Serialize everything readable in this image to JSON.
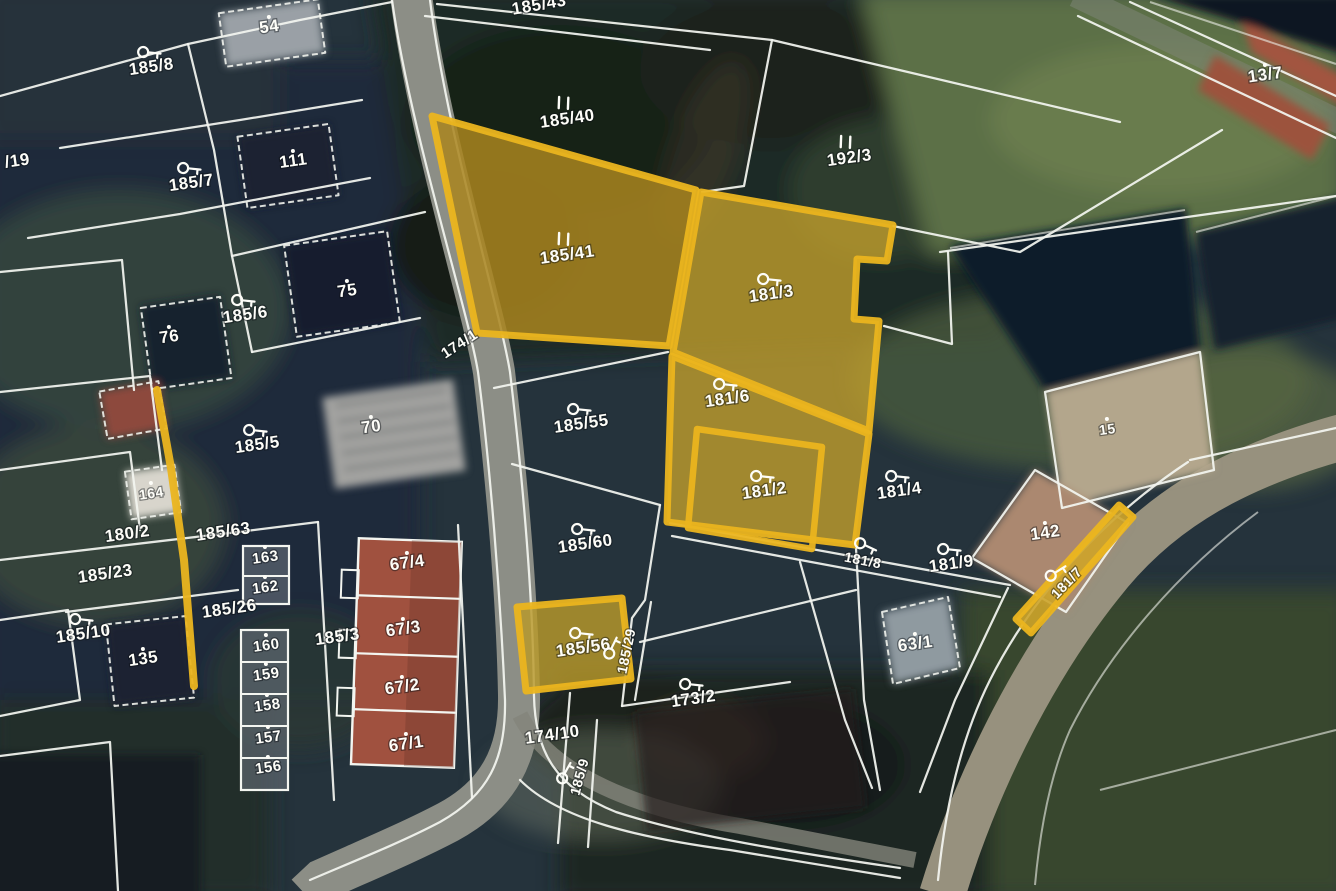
{
  "map": {
    "type": "cadastral-satellite-overlay",
    "colors": {
      "boundary_line": "#f3f5f0",
      "highlight_stroke": "#ebb51f",
      "highlight_fill_dark": "#a9851f",
      "highlight_fill_light": "#c4a02b",
      "label_text": "#fdfdf8"
    },
    "labels": [
      {
        "text": "54",
        "x": 270,
        "y": 32,
        "rot": -8,
        "dot": true
      },
      {
        "text": "185/8",
        "x": 152,
        "y": 72,
        "rot": -8,
        "icon": "key"
      },
      {
        "text": "/19",
        "x": 18,
        "y": 166,
        "rot": -8
      },
      {
        "text": "185/7",
        "x": 192,
        "y": 188,
        "rot": -8,
        "icon": "key"
      },
      {
        "text": "111",
        "x": 294,
        "y": 166,
        "rot": -8,
        "dot": true
      },
      {
        "text": "76",
        "x": 170,
        "y": 342,
        "rot": -8,
        "dot": true
      },
      {
        "text": "185/6",
        "x": 246,
        "y": 320,
        "rot": -8,
        "icon": "key"
      },
      {
        "text": "75",
        "x": 348,
        "y": 296,
        "rot": -8,
        "dot": true
      },
      {
        "text": "185/5",
        "x": 258,
        "y": 450,
        "rot": -8,
        "icon": "key"
      },
      {
        "text": "70",
        "x": 372,
        "y": 432,
        "rot": -8,
        "dot": true
      },
      {
        "text": "164",
        "x": 152,
        "y": 498,
        "rot": -8,
        "dot": true,
        "size": 14
      },
      {
        "text": "180/2",
        "x": 128,
        "y": 539,
        "rot": -8
      },
      {
        "text": "185/63",
        "x": 224,
        "y": 537,
        "rot": -8
      },
      {
        "text": "185/23",
        "x": 106,
        "y": 579,
        "rot": -8
      },
      {
        "text": "163",
        "x": 266,
        "y": 562,
        "rot": -8,
        "dot": true,
        "size": 15
      },
      {
        "text": "162",
        "x": 266,
        "y": 592,
        "rot": -8,
        "dot": true,
        "size": 15
      },
      {
        "text": "185/26",
        "x": 230,
        "y": 614,
        "rot": -8
      },
      {
        "text": "160",
        "x": 267,
        "y": 650,
        "rot": -8,
        "dot": true,
        "size": 15
      },
      {
        "text": "159",
        "x": 267,
        "y": 679,
        "rot": -8,
        "dot": true,
        "size": 15
      },
      {
        "text": "158",
        "x": 268,
        "y": 710,
        "rot": -8,
        "dot": true,
        "size": 15
      },
      {
        "text": "157",
        "x": 269,
        "y": 742,
        "rot": -8,
        "dot": true,
        "size": 15
      },
      {
        "text": "156",
        "x": 269,
        "y": 772,
        "rot": -8,
        "dot": true,
        "size": 15
      },
      {
        "text": "185/10",
        "x": 84,
        "y": 639,
        "rot": -8,
        "icon": "key"
      },
      {
        "text": "135",
        "x": 144,
        "y": 664,
        "rot": -8,
        "dot": true
      },
      {
        "text": "185/3",
        "x": 338,
        "y": 642,
        "rot": -8
      },
      {
        "text": "67/4",
        "x": 408,
        "y": 568,
        "rot": -8,
        "dot": true
      },
      {
        "text": "67/3",
        "x": 404,
        "y": 634,
        "rot": -8,
        "dot": true
      },
      {
        "text": "67/2",
        "x": 403,
        "y": 692,
        "rot": -8,
        "dot": true
      },
      {
        "text": "67/1",
        "x": 407,
        "y": 749,
        "rot": -8,
        "dot": true
      },
      {
        "text": "185/43",
        "x": 540,
        "y": 10,
        "rot": -10
      },
      {
        "text": "185/40",
        "x": 568,
        "y": 124,
        "rot": -8,
        "mark": true
      },
      {
        "text": "192/3",
        "x": 850,
        "y": 163,
        "rot": -8,
        "mark": true
      },
      {
        "text": "13/7",
        "x": 1266,
        "y": 80,
        "rot": -8,
        "dot": true
      },
      {
        "text": "185/41",
        "x": 568,
        "y": 260,
        "rot": -8,
        "mark": true
      },
      {
        "text": "174/1",
        "x": 462,
        "y": 348,
        "rot": -33,
        "size": 15
      },
      {
        "text": "185/55",
        "x": 582,
        "y": 429,
        "rot": -8,
        "icon": "key"
      },
      {
        "text": "181/3",
        "x": 772,
        "y": 299,
        "rot": -8,
        "icon": "key"
      },
      {
        "text": "181/6",
        "x": 728,
        "y": 404,
        "rot": -8,
        "icon": "key"
      },
      {
        "text": "181/2",
        "x": 765,
        "y": 496,
        "rot": -8,
        "icon": "key"
      },
      {
        "text": "181/4",
        "x": 900,
        "y": 496,
        "rot": -8,
        "icon": "key"
      },
      {
        "text": "15",
        "x": 1108,
        "y": 434,
        "rot": -8,
        "dot": true,
        "size": 14
      },
      {
        "text": "142",
        "x": 1046,
        "y": 538,
        "rot": -8,
        "dot": true
      },
      {
        "text": "181/9",
        "x": 952,
        "y": 569,
        "rot": -8,
        "icon": "key"
      },
      {
        "text": "181/8",
        "x": 862,
        "y": 565,
        "rot": 11,
        "icon": "key",
        "size": 14
      },
      {
        "text": "181/7",
        "x": 1070,
        "y": 586,
        "rot": -46,
        "icon": "key",
        "size": 14
      },
      {
        "text": "63/1",
        "x": 916,
        "y": 649,
        "rot": -8,
        "dot": true
      },
      {
        "text": "185/60",
        "x": 586,
        "y": 549,
        "rot": -8,
        "icon": "key"
      },
      {
        "text": "185/56",
        "x": 584,
        "y": 653,
        "rot": -8,
        "icon": "key"
      },
      {
        "text": "185/29",
        "x": 631,
        "y": 652,
        "rot": -78,
        "icon": "key",
        "size": 14
      },
      {
        "text": "173/2",
        "x": 694,
        "y": 704,
        "rot": -8,
        "icon": "key"
      },
      {
        "text": "174/10",
        "x": 553,
        "y": 740,
        "rot": -8
      },
      {
        "text": "185/9",
        "x": 584,
        "y": 778,
        "rot": -75,
        "icon": "key",
        "size": 14
      }
    ],
    "highlights": [
      {
        "id": "185-41",
        "type": "polygon",
        "points": [
          [
            432,
            116
          ],
          [
            696,
            190
          ],
          [
            669,
            346
          ],
          [
            477,
            333
          ]
        ],
        "fill": "#a9851f",
        "fill_opacity": 0.85
      },
      {
        "id": "181-3",
        "type": "polygon",
        "points": [
          [
            701,
            192
          ],
          [
            893,
            225
          ],
          [
            887,
            261
          ],
          [
            857,
            259
          ],
          [
            854,
            319
          ],
          [
            879,
            321
          ],
          [
            869,
            431
          ],
          [
            673,
            352
          ]
        ],
        "fill": "#c4a02b",
        "fill_opacity": 0.78
      },
      {
        "id": "181-6",
        "type": "polygon",
        "points": [
          [
            672,
            356
          ],
          [
            869,
            434
          ],
          [
            855,
            545
          ],
          [
            667,
            522
          ]
        ],
        "fill": "#c4a02b",
        "fill_opacity": 0.78
      },
      {
        "id": "181-2",
        "type": "outline",
        "points": [
          [
            697,
            429
          ],
          [
            822,
            447
          ],
          [
            812,
            549
          ],
          [
            688,
            528
          ]
        ],
        "stroke_width": 6.5
      },
      {
        "id": "185-56",
        "type": "polygon",
        "points": [
          [
            517,
            607
          ],
          [
            622,
            598
          ],
          [
            631,
            679
          ],
          [
            526,
            691
          ]
        ],
        "fill": "#b8982a",
        "fill_opacity": 0.82
      },
      {
        "id": "181-7",
        "type": "polygon",
        "points": [
          [
            1016,
            619
          ],
          [
            1119,
            505
          ],
          [
            1133,
            517
          ],
          [
            1031,
            633
          ]
        ],
        "fill": "#cda42a",
        "fill_opacity": 0.9
      },
      {
        "id": "boundary-strip-west",
        "type": "line",
        "points": [
          [
            157,
            390
          ],
          [
            171,
            468
          ],
          [
            184,
            560
          ],
          [
            194,
            686
          ]
        ],
        "stroke_width": 8
      }
    ]
  }
}
